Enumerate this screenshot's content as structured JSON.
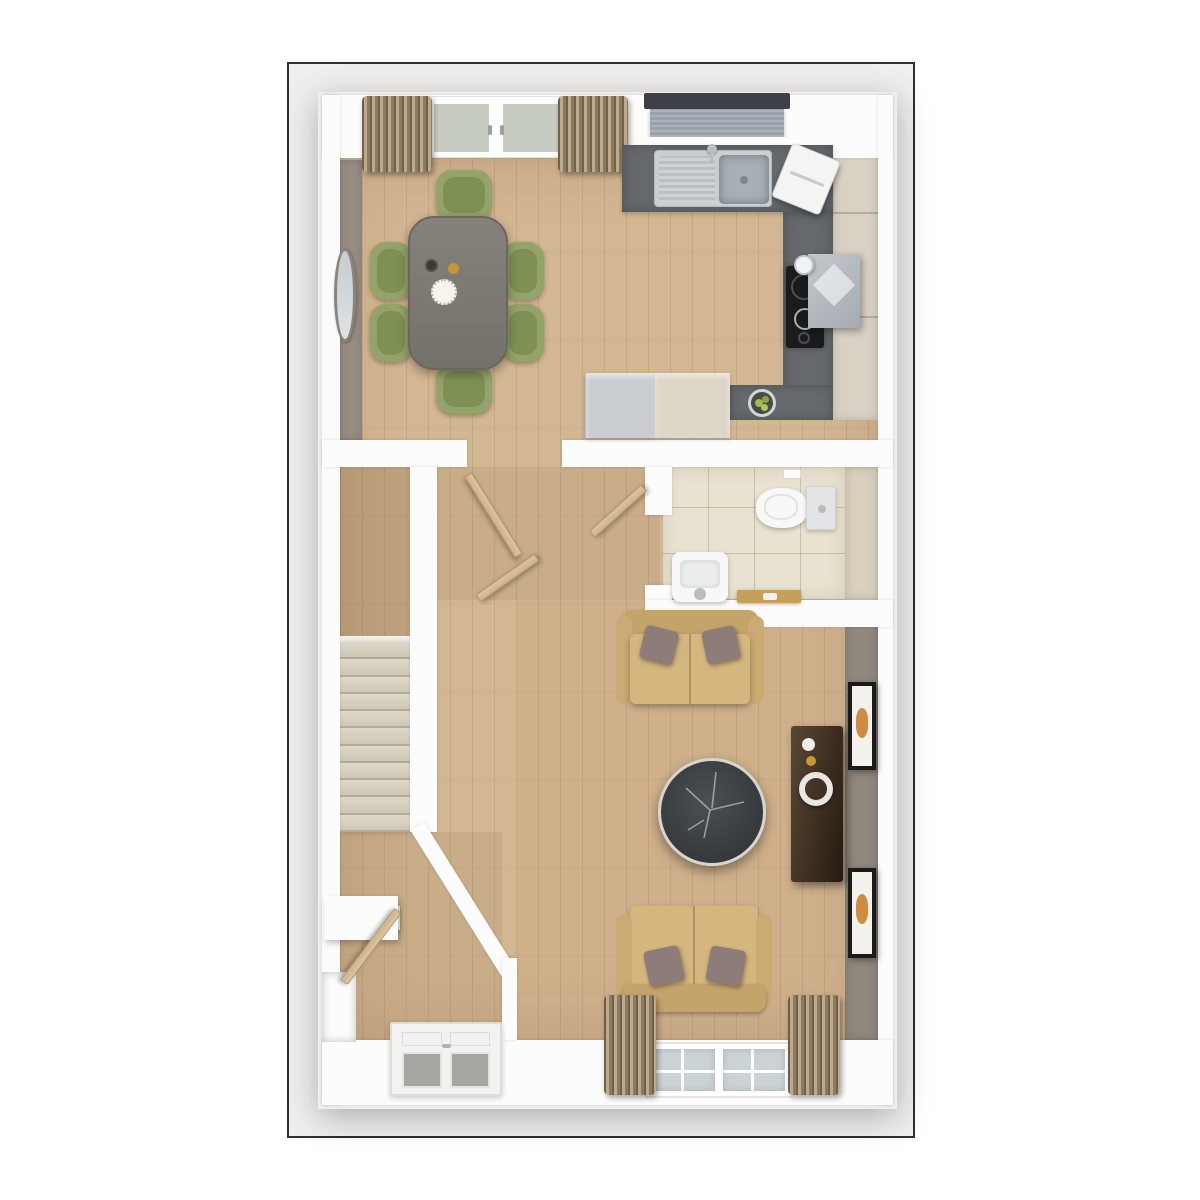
{
  "title": "ground-floor-plan-3d-top-view",
  "palette": {
    "frame": "#2f2f2f",
    "page": "#f0efee",
    "wall": "#fcfcfc",
    "wood": "#d3b692",
    "wood_line": "rgba(125,92,58,0.16)",
    "taupe": "#998d82",
    "living_wall": "#90877d",
    "wc_wall": "#d8cfbc",
    "cabinet": "#d9d1c4",
    "counter": "#65696d",
    "steel": "#c9ced2",
    "steel_dark": "#a9b0b5",
    "blind": "#99a1aa",
    "blind_bar": "#3d4145",
    "door_glass": "#c6cdc0",
    "glass": "#ccd3d7",
    "curtain_a": "#6f5f4c",
    "curtain_b": "#bcaa89",
    "curtain_c": "#8d7a61",
    "stairs": "#ded8ca",
    "step_edge": "rgba(120,108,88,0.4)",
    "tile": "#e9e2d0",
    "grout": "rgba(170,158,128,0.5)",
    "white_fix": "#f8f8f8",
    "cistern": "#e2e4e6",
    "tray": "#c79e5c",
    "table": "#7e7a73",
    "table_edge": "#6b6760",
    "chair": "#93a369",
    "chair_seat": "#7b8b4f",
    "sofa": "#d4b67e",
    "sofa_dark": "#c5a46c",
    "sofa_arm": "#cbab73",
    "pillow": "#8d7c77",
    "marble": "#3c4144",
    "marble_rim": "#d8d5ce",
    "vein": "#c8cdd0",
    "media_a": "#5a4734",
    "media_b": "#241b12",
    "frame_black": "#1c1a18",
    "mat": "#f3f1ec",
    "art": "#cf8c3e",
    "gold": "#c69733",
    "fridge": "#c9ccd1",
    "unit_cream": "#ded6c7",
    "hob": "#191b1d",
    "extractor": "#b6bbc1",
    "leaf": "#dbc5a1",
    "leaf_edge": "#b3946a",
    "mirror": "#8a847a",
    "hall_tint": "rgba(120,85,50,0.10)",
    "corridor_tint": "rgba(110,78,45,0.20)",
    "living_tint": "rgba(150,105,60,0.07)",
    "chrome": "#b9bec3"
  },
  "scene": {
    "view": "top-down 3d render",
    "rooms": [
      "kitchen-dining",
      "hallway",
      "wc",
      "stairs",
      "living-room",
      "entry"
    ],
    "kitchen_dining_items": [
      "french-doors",
      "curtains",
      "wall-mirror",
      "dining-table",
      "six-green-chairs",
      "plate",
      "gold-cup",
      "dark-cup",
      "l-shaped-worktop",
      "double-sink",
      "tap",
      "window-blind",
      "countertop-appliance",
      "extractor-hood",
      "kettle",
      "induction-hob",
      "fruit-bowl",
      "fridge",
      "base-unit",
      "tall-cabinets"
    ],
    "wc_items": [
      "toilet",
      "cistern",
      "toilet-roll-holder",
      "basin",
      "basin-tap",
      "wooden-tray",
      "tiled-floor"
    ],
    "hall_items": [
      "open-door-to-kitchen",
      "open-door-to-living-room",
      "open-door-to-wc",
      "carpeted-staircase",
      "under-stair-wall"
    ],
    "living_items": [
      "two-seat-sofa-top",
      "two-seat-sofa-bottom",
      "scatter-cushions",
      "round-marble-coffee-table",
      "dark-media-sideboard",
      "ring-ornament",
      "two-wall-art-frames",
      "window",
      "window-curtains"
    ],
    "entry_items": [
      "front-door-with-glazing",
      "console-shelf",
      "open-internal-door",
      "alcove"
    ]
  }
}
